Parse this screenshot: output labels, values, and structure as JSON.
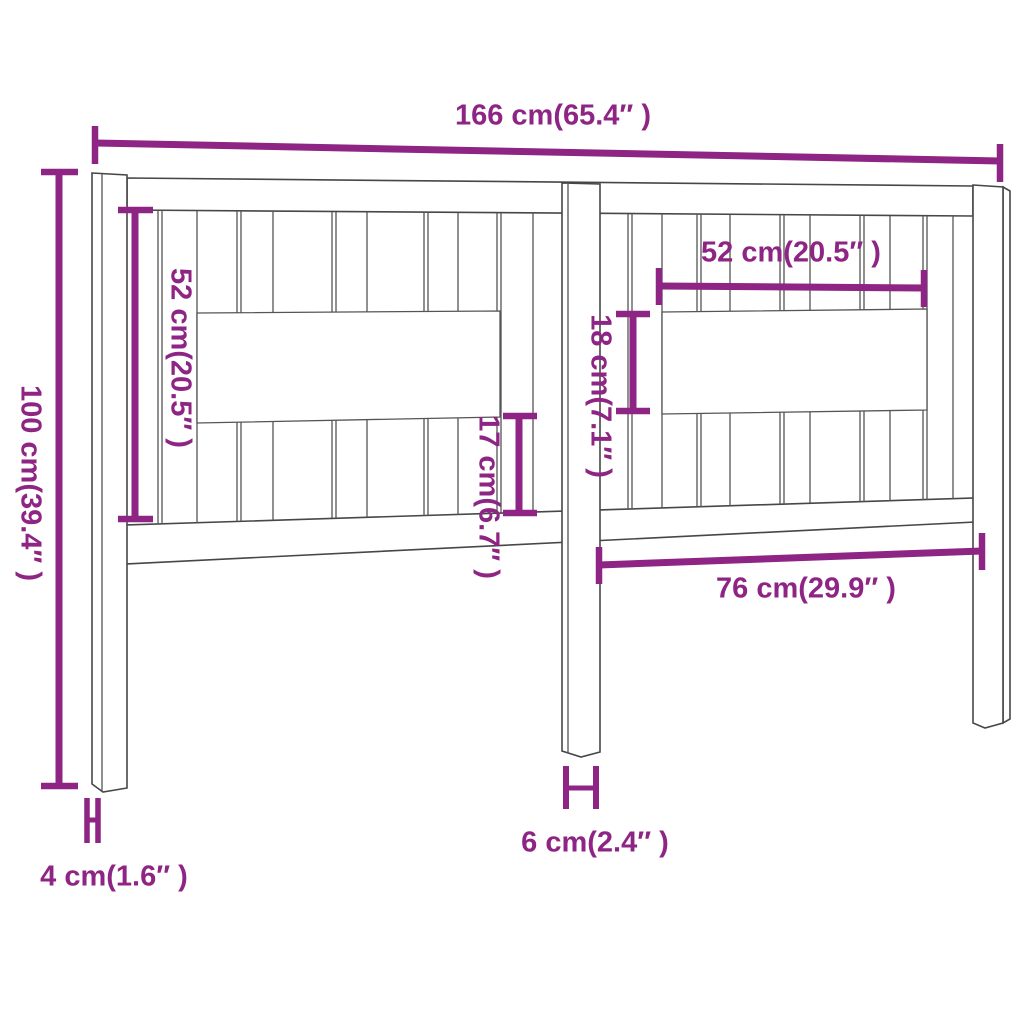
{
  "diagram": {
    "kind": "product-dimension-diagram",
    "subject": "wooden bed headboard with vertical slats, two side posts and a center leg",
    "colors": {
      "accent": "#8e2483",
      "line": "#474747",
      "background": "#ffffff"
    },
    "dimensions": {
      "overall_width": {
        "label": "166 cm(65.4″ )",
        "cm": 166,
        "inches": 65.4,
        "orientation": "horizontal"
      },
      "overall_height": {
        "label": "100 cm(39.4″ )",
        "cm": 100,
        "inches": 39.4,
        "orientation": "vertical"
      },
      "left_panel_height": {
        "label": "52 cm(20.5″ )",
        "cm": 52,
        "inches": 20.5,
        "orientation": "vertical"
      },
      "right_window_width": {
        "label": "52 cm(20.5″ )",
        "cm": 52,
        "inches": 20.5,
        "orientation": "horizontal"
      },
      "right_window_height": {
        "label": "18 cm(7.1″ )",
        "cm": 18,
        "inches": 7.1,
        "orientation": "vertical"
      },
      "lower_slat_height": {
        "label": "17 cm(6.7″ )",
        "cm": 17,
        "inches": 6.7,
        "orientation": "vertical"
      },
      "leg_to_post_span": {
        "label": "76 cm(29.9″ )",
        "cm": 76,
        "inches": 29.9,
        "orientation": "horizontal"
      },
      "center_leg_width": {
        "label": "6 cm(2.4″ )",
        "cm": 6,
        "inches": 2.4,
        "orientation": "horizontal"
      },
      "post_depth": {
        "label": "4 cm(1.6″ )",
        "cm": 4,
        "inches": 1.6,
        "orientation": "horizontal"
      }
    }
  }
}
